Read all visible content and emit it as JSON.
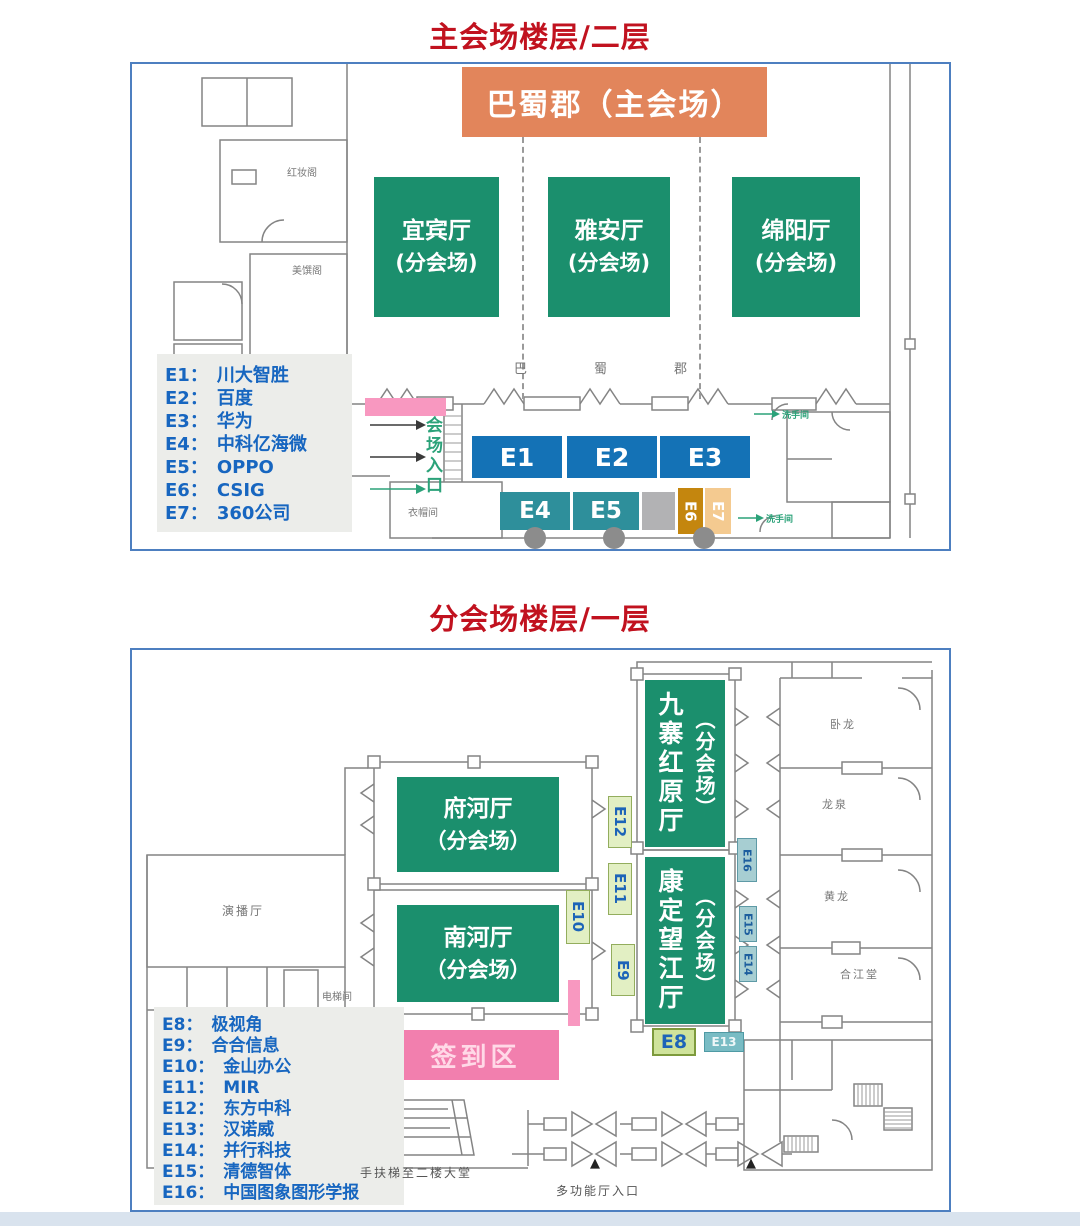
{
  "ui": {
    "colon": "："
  },
  "floor2": {
    "title": "主会场楼层/二层",
    "main_hall": "巴蜀郡（主会场）",
    "halls": [
      {
        "name": "宜宾厅",
        "sub": "(分会场)"
      },
      {
        "name": "雅安厅",
        "sub": "(分会场)"
      },
      {
        "name": "绵阳厅",
        "sub": "(分会场)"
      }
    ],
    "wall_chars": [
      "巴",
      "蜀",
      "郡"
    ],
    "legend": [
      {
        "id": "E1",
        "name": "川大智胜"
      },
      {
        "id": "E2",
        "name": "百度"
      },
      {
        "id": "E3",
        "name": "华为"
      },
      {
        "id": "E4",
        "name": "中科亿海微"
      },
      {
        "id": "E5",
        "name": "OPPO"
      },
      {
        "id": "E6",
        "name": "CSIG"
      },
      {
        "id": "E7",
        "name": "360公司"
      }
    ],
    "booths_top": [
      "E1",
      "E2",
      "E3"
    ],
    "booths_bottom": [
      "E4",
      "E5"
    ],
    "booth_e6": "E6",
    "booth_e7": "E7",
    "entrance": "会场入口",
    "cloakroom": "衣帽间",
    "restroom_top": "洗手间",
    "restroom_bottom": "洗手间",
    "room_left_top": "红妆阁",
    "room_left_bottom": "美馔阁"
  },
  "floor1": {
    "title": "分会场楼层/一层",
    "halls_h": [
      {
        "name": "府河厅",
        "sub": "（分会场）"
      },
      {
        "name": "南河厅",
        "sub": "（分会场）"
      }
    ],
    "halls_v": [
      {
        "name": "九寨红原厅",
        "sub": "（分会场）"
      },
      {
        "name": "康定望江厅",
        "sub": "（分会场）"
      }
    ],
    "signin": "签到区",
    "legend": [
      {
        "id": "E8",
        "name": "极视角"
      },
      {
        "id": "E9",
        "name": "合合信息"
      },
      {
        "id": "E10",
        "name": "金山办公"
      },
      {
        "id": "E11",
        "name": "MIR"
      },
      {
        "id": "E12",
        "name": "东方中科"
      },
      {
        "id": "E13",
        "name": "汉诺威"
      },
      {
        "id": "E14",
        "name": "并行科技"
      },
      {
        "id": "E15",
        "name": "清德智体"
      },
      {
        "id": "E16",
        "name": "中国图象图形学报"
      }
    ],
    "tags": {
      "e8": "E8",
      "e9": "E9",
      "e10": "E10",
      "e11": "E11",
      "e12": "E12",
      "e13": "E13",
      "e14": "E14",
      "e15": "E15",
      "e16": "E16"
    },
    "side_rooms": [
      "卧龙",
      "龙泉",
      "黄龙",
      "合江堂"
    ],
    "studio": "演播厅",
    "elevator": "电梯间",
    "escalator_note": "手扶梯至二楼大堂",
    "entrance_note": "多功能厅入口"
  }
}
